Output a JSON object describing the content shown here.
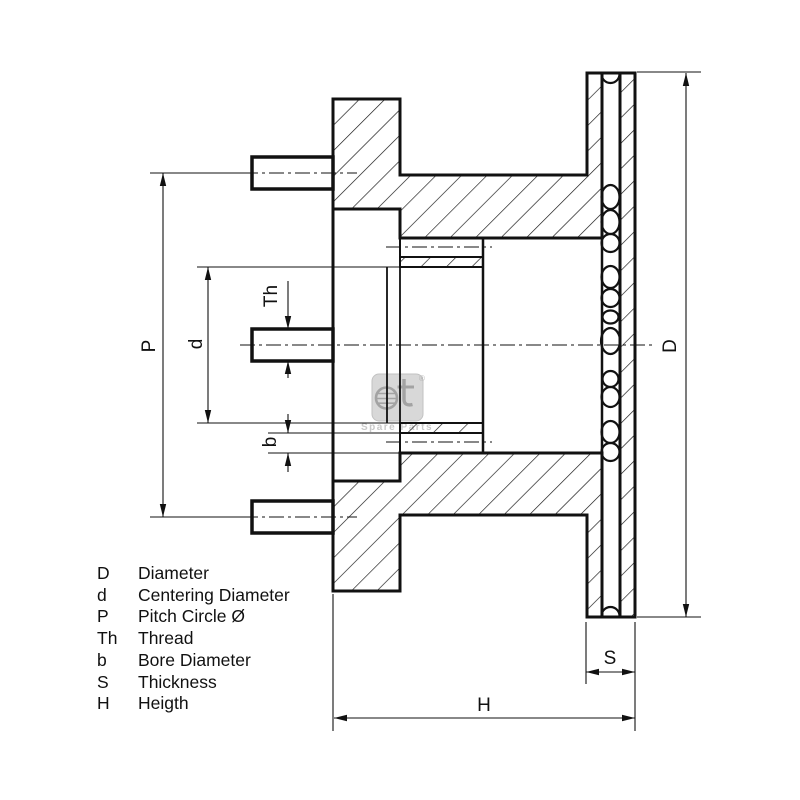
{
  "drawing": {
    "labels": {
      "pitch": "P",
      "centering": "d",
      "thread": "Th",
      "bore": "b",
      "diameter": "D",
      "thickness": "S",
      "height": "H"
    }
  },
  "watermark": {
    "registered": "®",
    "subtitle": "Spare Parts"
  },
  "legend": {
    "items": [
      {
        "key": "D",
        "label": "Diameter"
      },
      {
        "key": "d",
        "label": "Centering Diameter"
      },
      {
        "key": "P",
        "label": "Pitch Circle Ø"
      },
      {
        "key": "Th",
        "label": "Thread"
      },
      {
        "key": "b",
        "label": "Bore Diameter"
      },
      {
        "key": "S",
        "label": "Thickness"
      },
      {
        "key": "H",
        "label": "Heigth"
      }
    ]
  }
}
